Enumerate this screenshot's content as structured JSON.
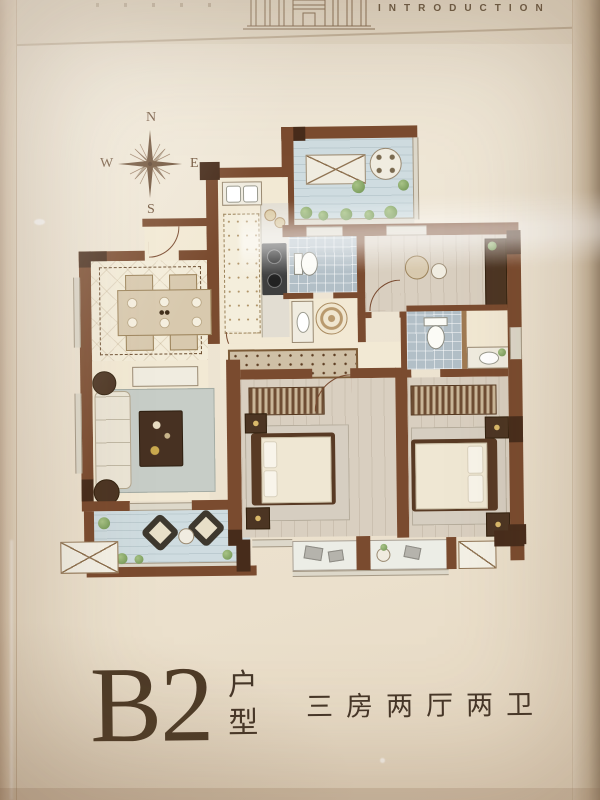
{
  "header": {
    "title": "INTRODUCTION"
  },
  "compass": {
    "north": "N",
    "south": "S",
    "east": "E",
    "west": "W"
  },
  "footer": {
    "unit_code": "B2",
    "unit_label_top": "户",
    "unit_label_bottom": "型",
    "layout_description": "三房两厅两卫"
  },
  "palette": {
    "wall_brown": "#7a4b2f",
    "wall_dark": "#472c1b",
    "floor_cream": "#f2e9d4",
    "floor_wood": "#d9cfc0",
    "floor_tile": "#b2bfc7",
    "floor_balcony": "#cfdce0",
    "text_brown": "#4d3b27"
  }
}
